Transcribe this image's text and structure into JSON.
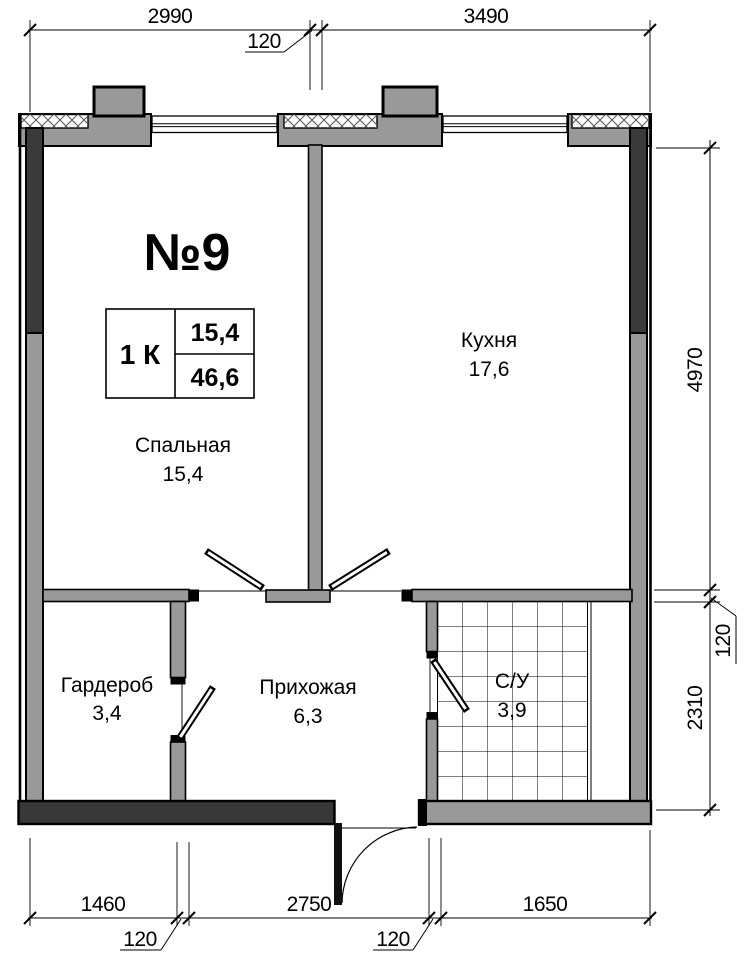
{
  "plan": {
    "apartment_number": "№9",
    "info_table": {
      "type_label": "1 К",
      "living_area": "15,4",
      "total_area": "46,6"
    },
    "rooms": [
      {
        "name": "Спальная",
        "area": "15,4"
      },
      {
        "name": "Кухня",
        "area": "17,6"
      },
      {
        "name": "Гардероб",
        "area": "3,4"
      },
      {
        "name": "Прихожая",
        "area": "6,3"
      },
      {
        "name": "С/У",
        "area": "3,9"
      }
    ],
    "dimensions": {
      "top": [
        "2990",
        "120",
        "3490"
      ],
      "right": [
        "4970",
        "120",
        "2310"
      ],
      "bottom": [
        "1460",
        "120",
        "2750",
        "120",
        "1650"
      ]
    },
    "colors": {
      "accent_red": "#c01e1c",
      "wall_gray": "#999999",
      "wall_dark": "#3a3a3a"
    }
  }
}
